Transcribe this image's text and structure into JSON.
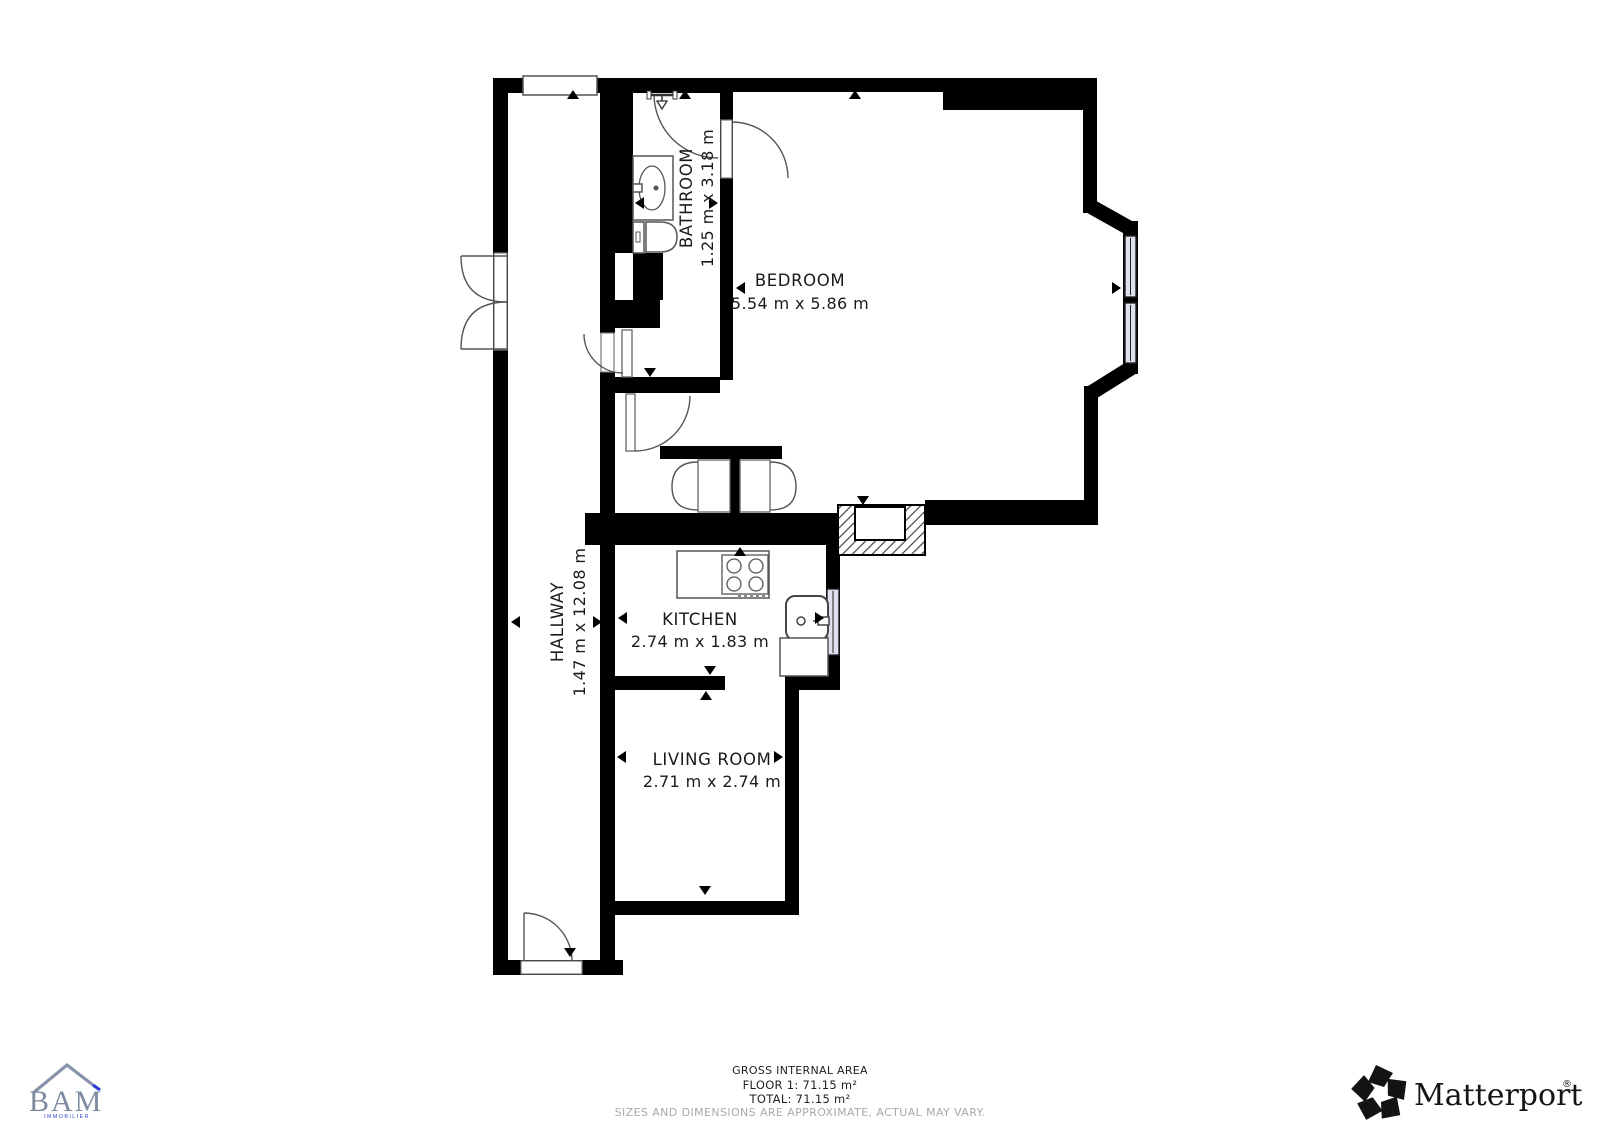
{
  "plan": {
    "rooms": {
      "bedroom": {
        "label": "BEDROOM",
        "dims": "5.54 m x 5.86 m"
      },
      "bathroom": {
        "label": "BATHROOM",
        "dims": "1.25 m x 3.18 m"
      },
      "hallway": {
        "label": "HALLWAY",
        "dims": "1.47 m x 12.08 m"
      },
      "kitchen": {
        "label": "KITCHEN",
        "dims": "2.74 m x 1.83 m"
      },
      "living": {
        "label": "LIVING ROOM",
        "dims": "2.71 m x 2.74 m"
      }
    }
  },
  "footer": {
    "area_title": "GROSS INTERNAL AREA",
    "floor_line": "FLOOR 1: 71.15 m²",
    "total_line": "TOTAL: 71.15 m²",
    "disclaimer": "SIZES AND DIMENSIONS ARE APPROXIMATE, ACTUAL MAY VARY."
  },
  "branding": {
    "agency": {
      "name": "BAM",
      "subtitle": "IMMOBILIER",
      "roof_color": "#8693aa",
      "text_color": "#7e8ba2",
      "accent_color": "#2f3cd4"
    },
    "matterport": {
      "name": "Matterport",
      "registered": "®",
      "color": "#141414"
    }
  },
  "colors": {
    "wall": "#000000",
    "background": "#ffffff",
    "window_fill": "#dfe0ef",
    "footer_text": "#1f1f1f",
    "disclaimer_text": "#a9a9a9"
  }
}
